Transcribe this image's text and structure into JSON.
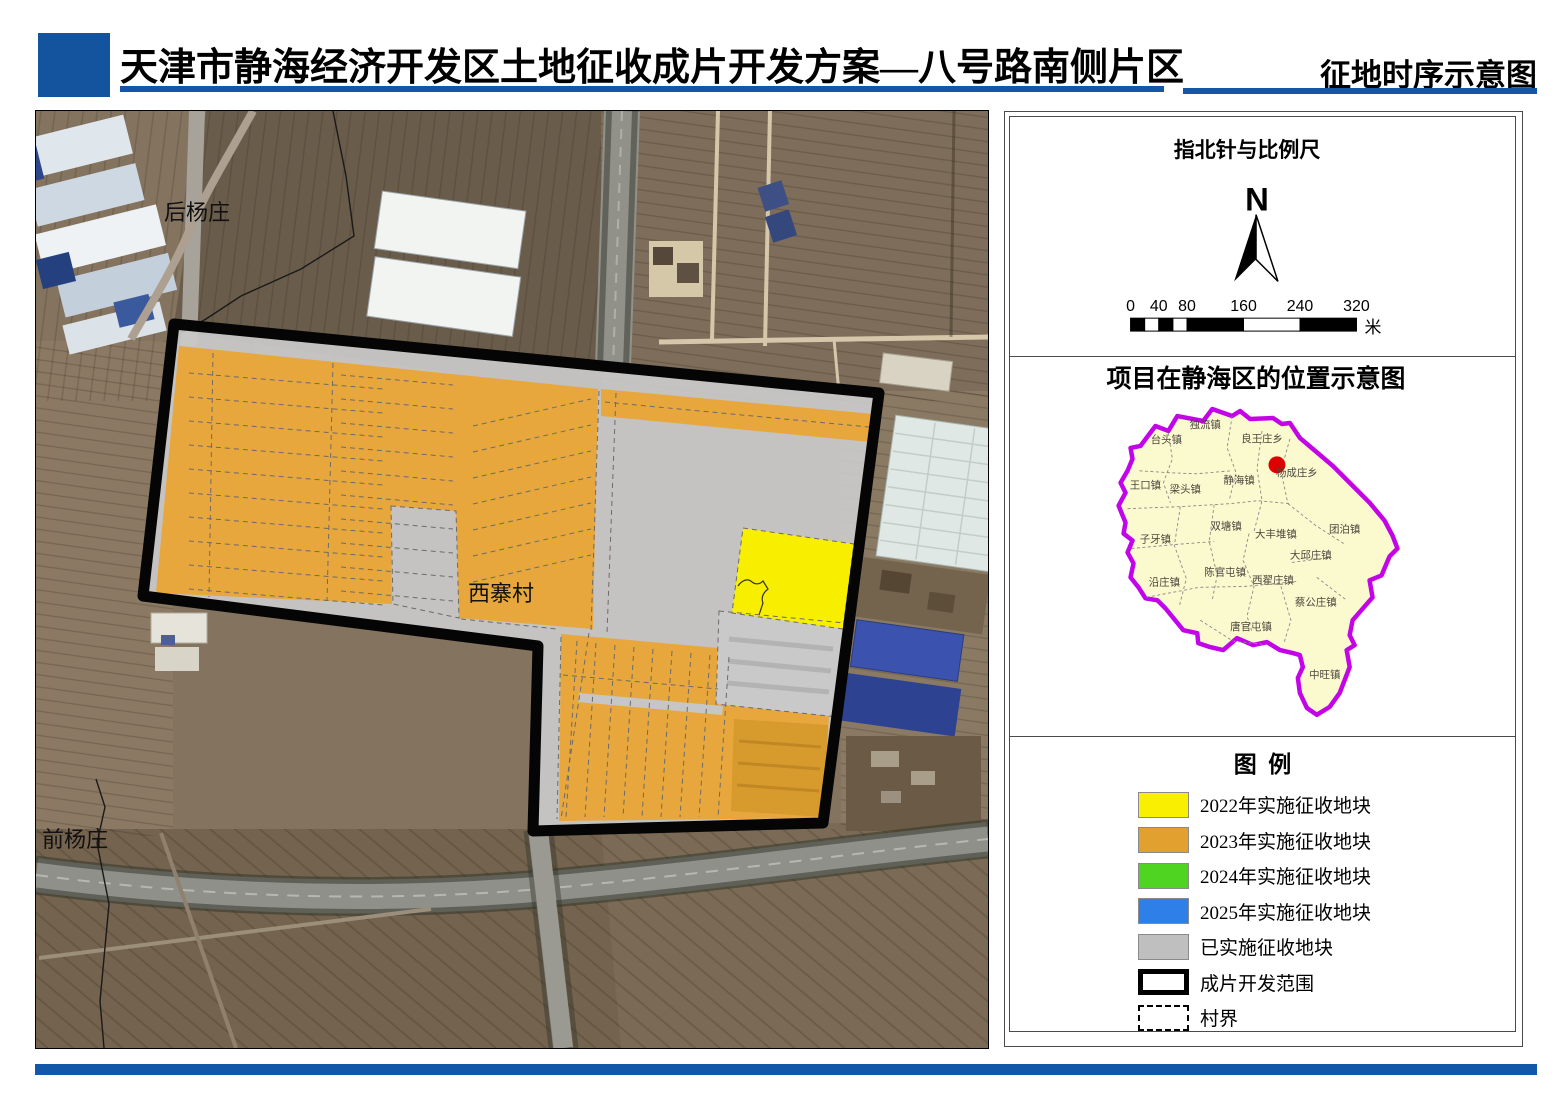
{
  "header": {
    "title": "天津市静海经济开发区土地征收成片开发方案—八号路南侧片区",
    "subtitle": "征地时序示意图",
    "accent_color": "#1358A8"
  },
  "main_map": {
    "village_labels": [
      {
        "name": "后杨庄",
        "x": 196,
        "y": 219
      },
      {
        "name": "西寨村",
        "x": 500,
        "y": 600
      },
      {
        "name": "前杨庄",
        "x": 74,
        "y": 846
      }
    ]
  },
  "side_panel": {
    "compass": {
      "title": "指北针与比例尺",
      "north_letter": "N",
      "scale_ticks": [
        0,
        40,
        80,
        160,
        240,
        320
      ],
      "scale_unit": "米"
    },
    "location_map": {
      "title": "项目在静海区的位置示意图",
      "marker_color": "#DF0101",
      "boundary_color": "#C303E8",
      "fill_color": "#FBF9CE",
      "towns": [
        {
          "name": "独流镇",
          "x": 1205,
          "y": 427
        },
        {
          "name": "台头镇",
          "x": 1166,
          "y": 442
        },
        {
          "name": "良王庄乡",
          "x": 1262,
          "y": 441
        },
        {
          "name": "杨成庄乡",
          "x": 1297,
          "y": 475
        },
        {
          "name": "静海镇",
          "x": 1239,
          "y": 483
        },
        {
          "name": "王口镇",
          "x": 1145,
          "y": 488
        },
        {
          "name": "梁头镇",
          "x": 1185,
          "y": 492
        },
        {
          "name": "双塘镇",
          "x": 1226,
          "y": 529
        },
        {
          "name": "大丰堆镇",
          "x": 1276,
          "y": 537
        },
        {
          "name": "团泊镇",
          "x": 1345,
          "y": 532
        },
        {
          "name": "子牙镇",
          "x": 1155,
          "y": 542
        },
        {
          "name": "大邱庄镇",
          "x": 1311,
          "y": 558
        },
        {
          "name": "陈官屯镇",
          "x": 1225,
          "y": 575
        },
        {
          "name": "西翟庄镇",
          "x": 1273,
          "y": 583
        },
        {
          "name": "沿庄镇",
          "x": 1164,
          "y": 585
        },
        {
          "name": "蔡公庄镇",
          "x": 1316,
          "y": 605
        },
        {
          "name": "唐官屯镇",
          "x": 1251,
          "y": 630
        },
        {
          "name": "中旺镇",
          "x": 1325,
          "y": 678
        }
      ]
    },
    "legend": {
      "title": "图  例",
      "items": [
        {
          "label": "2022年实施征收地块",
          "type": "fill",
          "color": "#F8F000"
        },
        {
          "label": "2023年实施征收地块",
          "type": "fill",
          "color": "#E2A12E"
        },
        {
          "label": "2024年实施征收地块",
          "type": "fill",
          "color": "#4FD421"
        },
        {
          "label": "2025年实施征收地块",
          "type": "fill",
          "color": "#2E7FE8"
        },
        {
          "label": "已实施征收地块",
          "type": "fill",
          "color": "#BFBFBF"
        },
        {
          "label": "成片开发范围",
          "type": "thick-outline",
          "color": "#000000"
        },
        {
          "label": "村界",
          "type": "dashed-outline",
          "color": "#000000"
        }
      ]
    }
  }
}
